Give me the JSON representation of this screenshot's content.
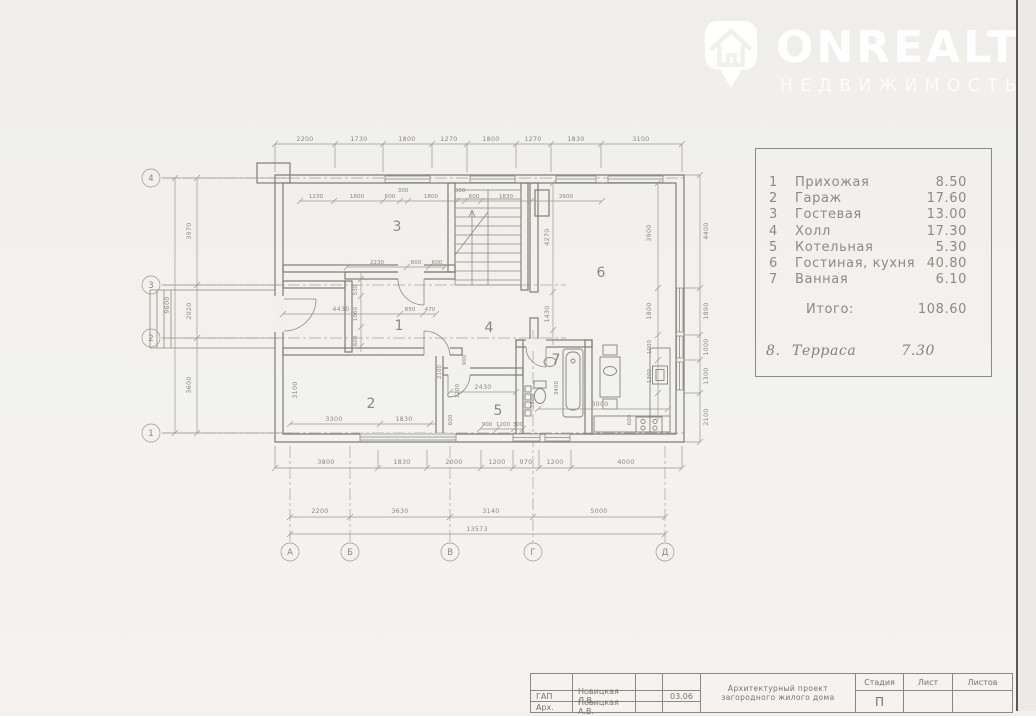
{
  "watermark": {
    "brand": "ONREALT",
    "subtitle": "НЕДВИЖИМОСТЬ"
  },
  "legend": {
    "rows": [
      {
        "num": "1",
        "name": "Прихожая",
        "area": "8.50"
      },
      {
        "num": "2",
        "name": "Гараж",
        "area": "17.60"
      },
      {
        "num": "3",
        "name": "Гостевая",
        "area": "13.00"
      },
      {
        "num": "4",
        "name": "Холл",
        "area": "17.30"
      },
      {
        "num": "5",
        "name": "Котельная",
        "area": "5.30"
      },
      {
        "num": "6",
        "name": "Гостиная,  кухня",
        "area": "40.80"
      },
      {
        "num": "7",
        "name": "Ванная",
        "area": "6.10"
      }
    ],
    "total_label": "Итого:",
    "total_value": "108.60",
    "terrace_num": "8.",
    "terrace_name": "Терраса",
    "terrace_area": "7.30"
  },
  "plan": {
    "rooms": {
      "r1": "1",
      "r2": "2",
      "r3": "3",
      "r4": "4",
      "r5": "5",
      "r6": "6",
      "r7": "7"
    },
    "axes_cols": [
      "А",
      "Б",
      "В",
      "Г",
      "Д"
    ],
    "axes_rows": [
      "4",
      "3",
      "2",
      "1"
    ],
    "dims": {
      "top": [
        "2200",
        "1730",
        "1800",
        "1270",
        "1800",
        "1270",
        "1830",
        "3100"
      ],
      "top_inner": [
        "1230",
        "1800",
        "600",
        "300",
        "1800",
        "300",
        "600",
        "1830",
        "2600"
      ],
      "room1_top": [
        "2230",
        "800",
        "600"
      ],
      "room1_left": [
        "530",
        "1060",
        "600"
      ],
      "garage_width": "4430",
      "garage_mid": [
        "850",
        "470"
      ],
      "garage_height": "3100",
      "garage_bottom": [
        "3300",
        "1830"
      ],
      "mid_vertical": [
        "2100",
        "900",
        "1200"
      ],
      "room5_width": "2430",
      "room5_bottom": [
        "900",
        "1200",
        "300"
      ],
      "room5_left": "600",
      "room7_vertical": [
        "2500",
        "3400"
      ],
      "room6_left": [
        "4270",
        "1430"
      ],
      "room6_right": [
        "3900",
        "1800",
        "1000",
        "1300",
        "600"
      ],
      "room6_bottom": "3000",
      "bottom1": [
        "3800",
        "1830",
        "2000",
        "1200",
        "970",
        "1200",
        "4000"
      ],
      "bottom2": [
        "2200",
        "3630",
        "3140",
        "5000"
      ],
      "total": "13573",
      "left": [
        "3970",
        "2020",
        "3600"
      ],
      "left_total": "9600",
      "right": [
        "4400",
        "1890",
        "1000",
        "1300",
        "2100"
      ]
    }
  },
  "titleblock": {
    "row1_role": "ГАП",
    "row1_name": "Новицкая Л.В.",
    "row1_date": "03.06",
    "row2_role": "Арх.",
    "row2_name": "Новицкая А.В.",
    "project_line1": "Архитектурный  проект",
    "project_line2": "загородного  жилого  дома",
    "stage_label": "Стадия",
    "sheet_label": "Лист",
    "sheets_label": "Листов",
    "stage_value": "П"
  }
}
